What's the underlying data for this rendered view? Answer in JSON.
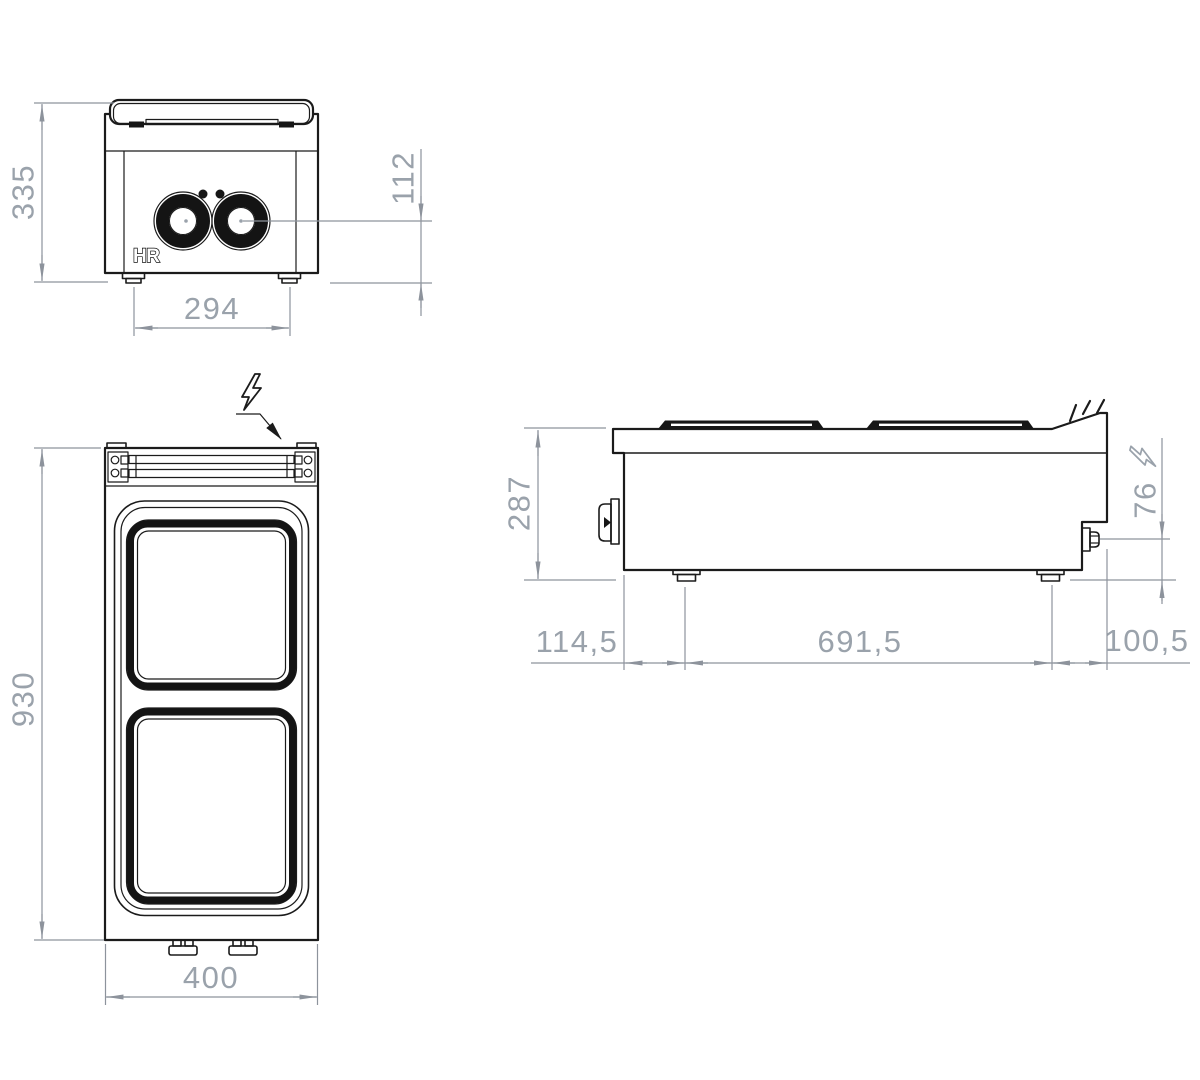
{
  "logo": "HR",
  "dimensions": {
    "front": {
      "height": "335",
      "control_axis_height": "112",
      "feet_span": "294"
    },
    "plan": {
      "depth": "930",
      "width": "400"
    },
    "side": {
      "height": "287",
      "inlet_height": "76",
      "front_foot_offset": "114,5",
      "feet_distance": "691,5",
      "rear_offset": "100,5"
    }
  },
  "symbols": {
    "electrical_connection_top": "lightning-bolt",
    "electrical_connection_side": "lightning-bolt"
  },
  "colors": {
    "outline": "#1b1b1b",
    "dimension_line": "#8d939c",
    "dimension_text": "#9aa2ab",
    "background": "#ffffff"
  }
}
